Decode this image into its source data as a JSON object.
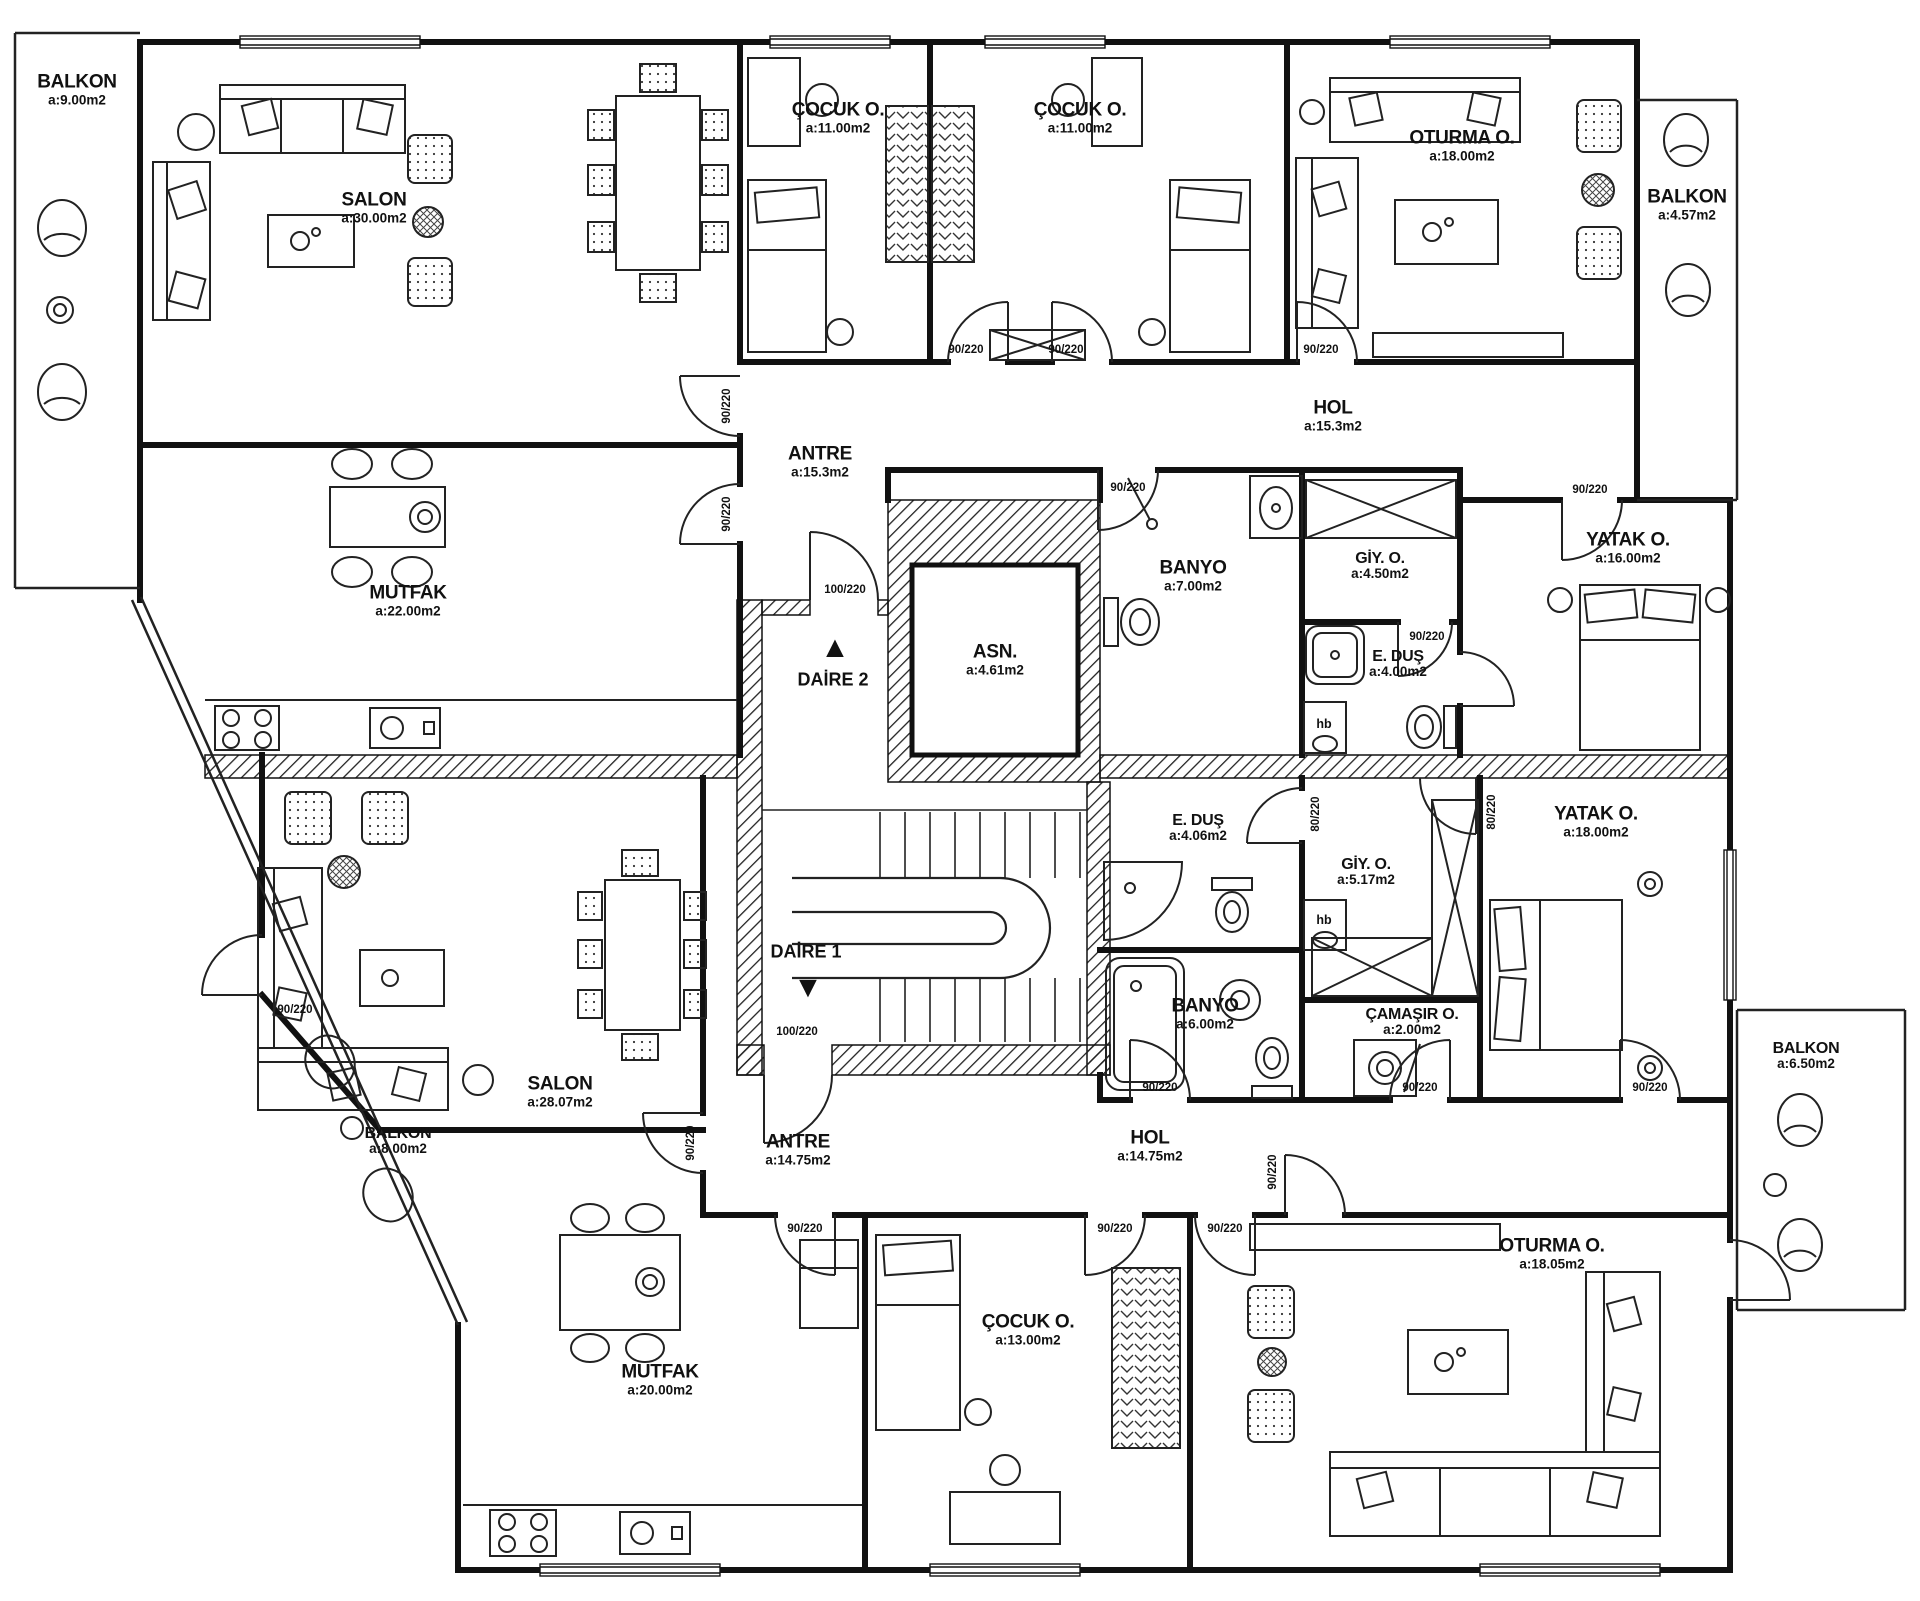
{
  "plan": {
    "rooms": {
      "balkon_ul": {
        "name": "BALKON",
        "area": "a:9.00m2"
      },
      "salon_u": {
        "name": "SALON",
        "area": "a:30.00m2"
      },
      "cocuk_u1": {
        "name": "ÇOCUK O.",
        "area": "a:11.00m2"
      },
      "cocuk_u2": {
        "name": "ÇOCUK O.",
        "area": "a:11.00m2"
      },
      "oturma_u": {
        "name": "OTURMA O.",
        "area": "a:18.00m2"
      },
      "balkon_ur": {
        "name": "BALKON",
        "area": "a:4.57m2"
      },
      "mutfak_u": {
        "name": "MUTFAK",
        "area": "a:22.00m2"
      },
      "antre_u": {
        "name": "ANTRE",
        "area": "a:15.3m2"
      },
      "hol_u": {
        "name": "HOL",
        "area": "a:15.3m2"
      },
      "banyo_u": {
        "name": "BANYO",
        "area": "a:7.00m2"
      },
      "giy_u": {
        "name": "GİY. O.",
        "area": "a:4.50m2"
      },
      "edus_u": {
        "name": "E. DUŞ",
        "area": "a:4.00m2"
      },
      "yatak_u": {
        "name": "YATAK O.",
        "area": "a:16.00m2"
      },
      "asn": {
        "name": "ASN.",
        "area": "a:4.61m2"
      },
      "salon_l": {
        "name": "SALON",
        "area": "a:28.07m2"
      },
      "mutfak_l": {
        "name": "MUTFAK",
        "area": "a:20.00m2"
      },
      "balkon_ll": {
        "name": "BALKON",
        "area": "a:8.00m2"
      },
      "antre_l": {
        "name": "ANTRE",
        "area": "a:14.75m2"
      },
      "hol_l": {
        "name": "HOL",
        "area": "a:14.75m2"
      },
      "edus_l": {
        "name": "E. DUŞ",
        "area": "a:4.06m2"
      },
      "giy_l": {
        "name": "GİY. O.",
        "area": "a:5.17m2"
      },
      "banyo_l": {
        "name": "BANYO",
        "area": "a:6.00m2"
      },
      "camasir": {
        "name": "ÇAMAŞIR O.",
        "area": "a:2.00m2"
      },
      "yatak_l": {
        "name": "YATAK O.",
        "area": "a:18.00m2"
      },
      "cocuk_l": {
        "name": "ÇOCUK O.",
        "area": "a:13.00m2"
      },
      "oturma_l": {
        "name": "OTURMA O.",
        "area": "a:18.05m2"
      },
      "balkon_lr": {
        "name": "BALKON",
        "area": "a:6.50m2"
      }
    },
    "units": {
      "daire2": {
        "label": "DAİRE 2"
      },
      "daire1": {
        "label": "DAİRE 1"
      }
    },
    "door_labels": {
      "d90": "90/220",
      "d100": "100/220",
      "d80": "80/220"
    },
    "fixtures": {
      "hb": "hb"
    },
    "icons": {
      "up_triangle": "▲",
      "down_triangle": "▼"
    },
    "colors": {
      "line": "#1a1a1a",
      "background": "#ffffff"
    }
  }
}
